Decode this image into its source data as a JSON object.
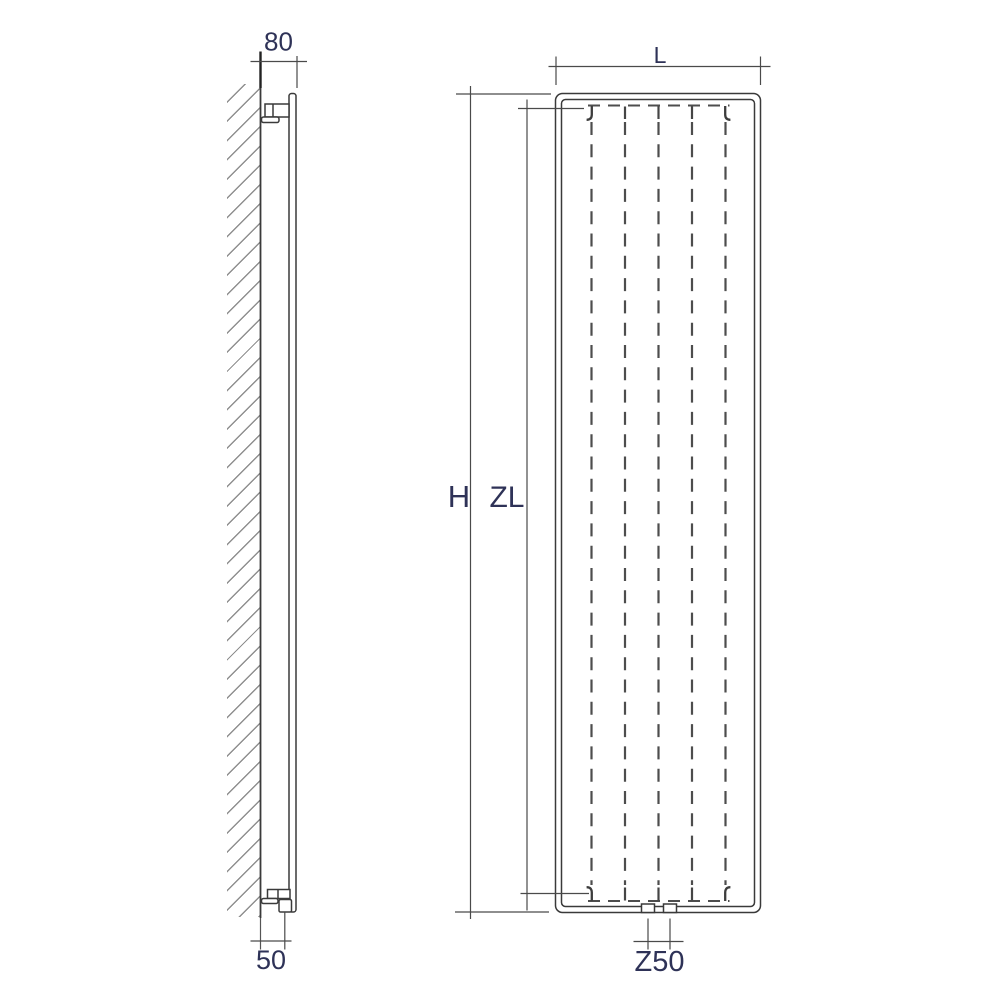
{
  "drawing": {
    "side_view": {
      "depth": "80",
      "pipe_wall_distance": "50"
    },
    "front_view": {
      "width": "L",
      "height": "H",
      "heating_element_length": "ZL",
      "pipe_centres": "Z50"
    }
  },
  "colors": {
    "line": "#3a3a3a",
    "label": "#2e3257",
    "hatch": "#8f8f8f",
    "background": "#ffffff"
  }
}
